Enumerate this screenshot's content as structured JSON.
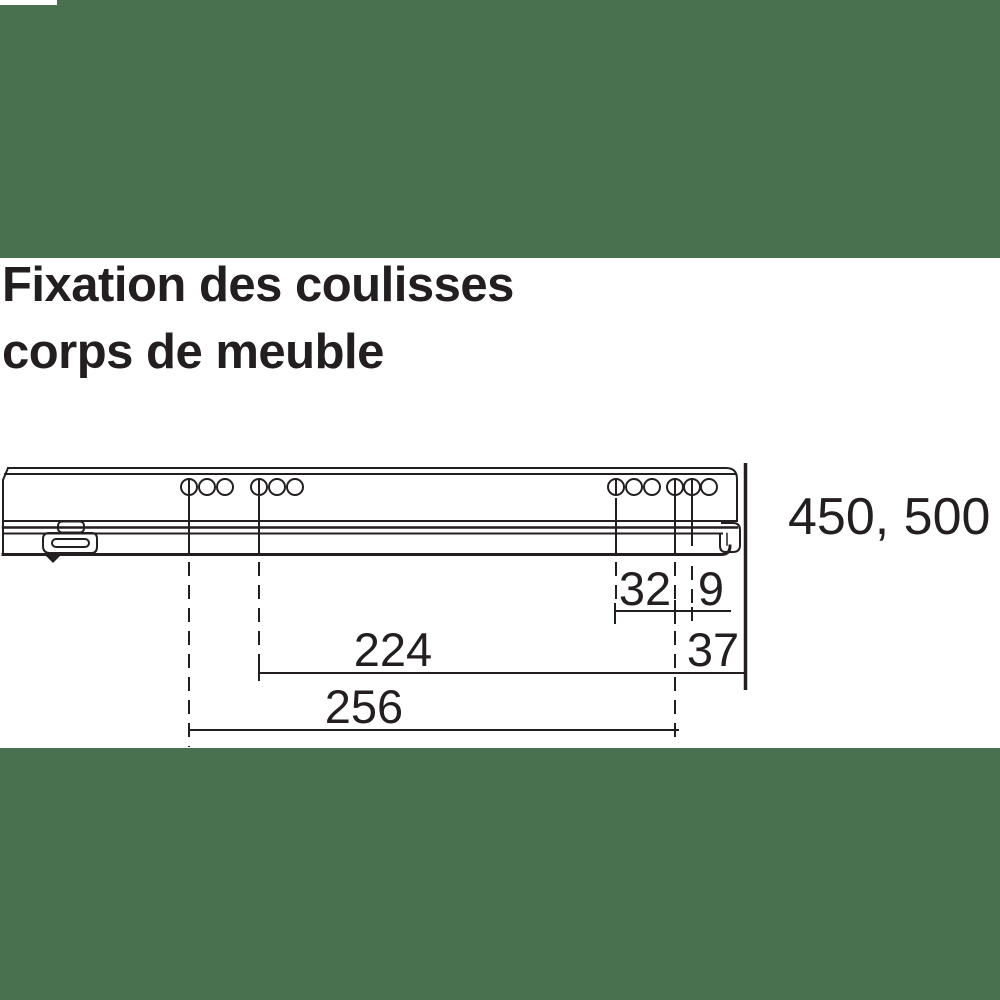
{
  "colors": {
    "background": "#497150",
    "canvas": "#ffffff",
    "ink": "#231f20"
  },
  "title": {
    "line1": "Fixation des coulisses",
    "line2": "corps de meuble"
  },
  "drawing": {
    "length_options_label": "450, 500",
    "dimensions": {
      "spacing_32": "32",
      "spacing_9": "9",
      "distance_224": "224",
      "edge_distance_37": "37",
      "distance_256": "256"
    }
  }
}
